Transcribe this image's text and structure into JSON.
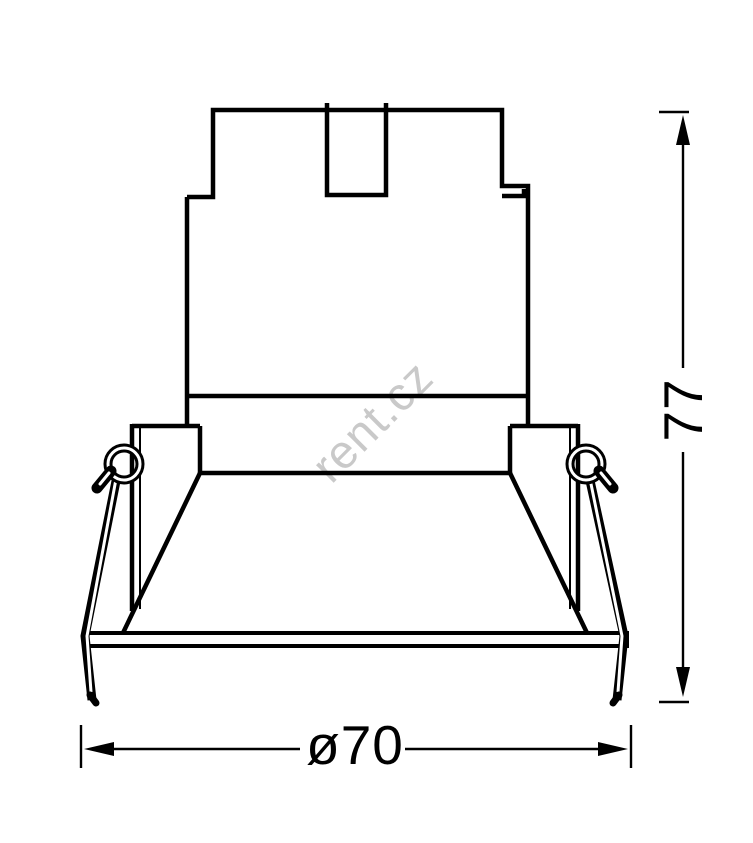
{
  "drawing": {
    "watermark_text": "rent.cz",
    "height_dimension": {
      "label": "77",
      "value": 77
    },
    "diameter_dimension": {
      "label": "ø70",
      "value": 70
    },
    "colors": {
      "line": "#000000",
      "background": "#ffffff",
      "watermark": "#c9c9c9"
    }
  }
}
